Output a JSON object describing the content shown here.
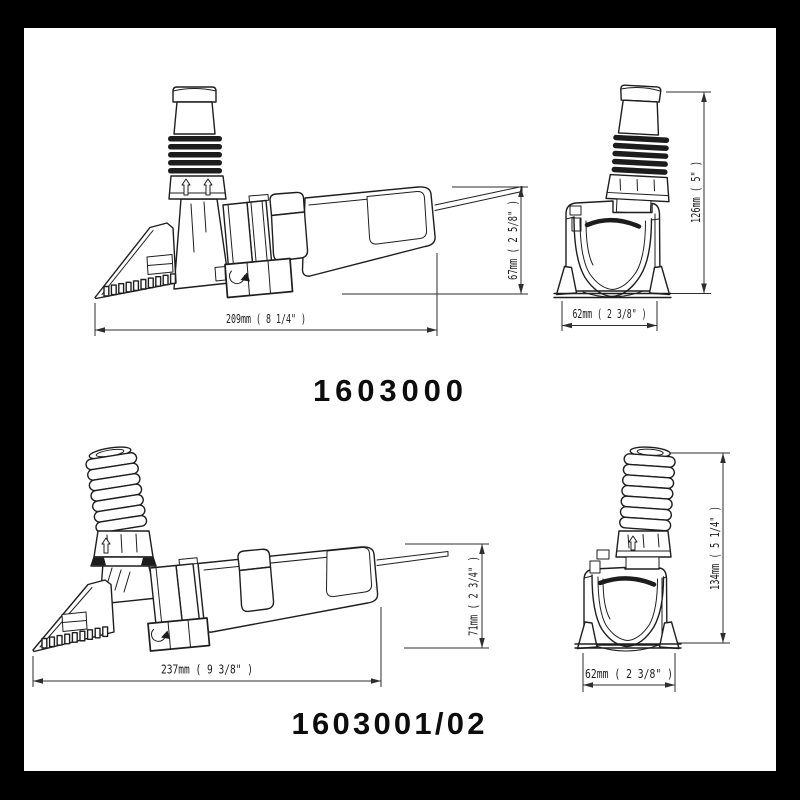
{
  "document_type": "product dimensional drawing",
  "colors": {
    "background": "#000000",
    "paper": "#ffffff",
    "line": "#1e1e1e",
    "dimension": "#2e2e2e",
    "label": "#0d0d0d"
  },
  "products": [
    {
      "model": "1603000",
      "side_view": {
        "length": "209mm ( 8 1/4\" )",
        "height": "67mm ( 2 5/8\" )"
      },
      "front_view": {
        "height": "126mm ( 5\" )",
        "width": "62mm ( 2 3/8\" )"
      }
    },
    {
      "model": "1603001/02",
      "side_view": {
        "length": "237mm ( 9 3/8\" )",
        "height": "71mm ( 2 3/4\" )"
      },
      "front_view": {
        "height": "134mm ( 5 1/4\" )",
        "width": "62mm ( 2 3/8\" )"
      }
    }
  ]
}
